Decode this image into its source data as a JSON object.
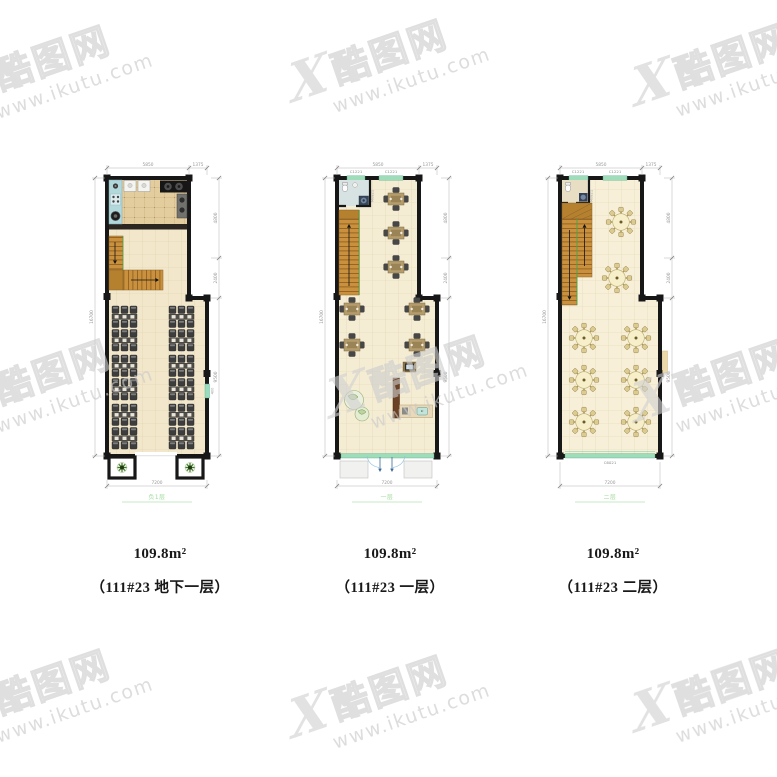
{
  "watermark": {
    "mark": "X",
    "brand": "酷图网",
    "url": "www.ikutu.com"
  },
  "plans": [
    {
      "area": "109.8m²",
      "name": "（111#23 地下一层）",
      "caption": "负1层",
      "dims": {
        "top1": "5850",
        "top2": "1375",
        "left": "16700",
        "right1": "4800",
        "right2": "2400",
        "right3": "9500",
        "bottom": "7200",
        "side": "400"
      }
    },
    {
      "area": "109.8m²",
      "name": "（111#23 一层）",
      "caption": "一层",
      "dims": {
        "top1": "5850",
        "top2": "1375",
        "left": "16700",
        "right1": "4800",
        "right2": "2400",
        "right3": "9500",
        "bottom": "7200"
      },
      "labels": {
        "window1": "C1221",
        "window2": "C1221",
        "door": "M0821"
      }
    },
    {
      "area": "109.8m²",
      "name": "（111#23 二层）",
      "caption": "二层",
      "dims": {
        "top1": "5850",
        "top2": "1375",
        "left": "16700",
        "right1": "4800",
        "right2": "2400",
        "right3": "9500",
        "bottom": "7200"
      },
      "labels": {
        "window1": "C1221",
        "window2": "C1221",
        "door": "M0821",
        "window_bottom": "C6021"
      }
    }
  ]
}
